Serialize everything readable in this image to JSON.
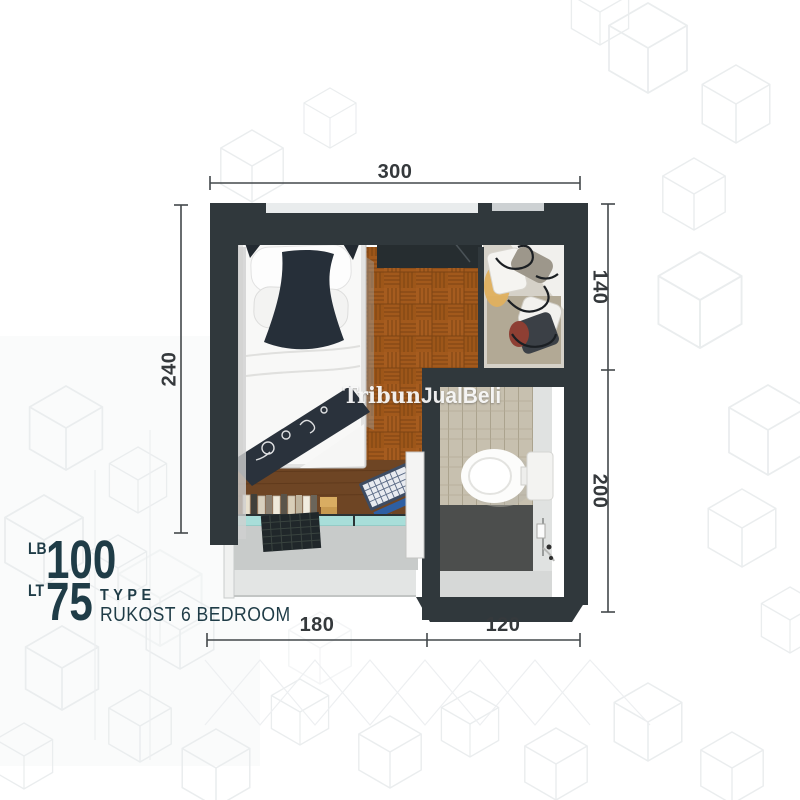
{
  "watermark": {
    "part1": "Tribun",
    "part2": "JualBeli"
  },
  "dims": {
    "top": "300",
    "left": "240",
    "right_upper": "140",
    "right_lower": "200",
    "bottom_left": "180",
    "bottom_right": "120"
  },
  "info": {
    "lb_label": "LB",
    "lb_value": "100",
    "lt_label": "LT",
    "lt_value": "75",
    "type_label": "TYPE",
    "type_name": "RUKOST 6 BEDROOM"
  },
  "palette": {
    "wall_dark": "#30383c",
    "wood_floor": "#a2591c",
    "desk_wood": "#6e4524",
    "glass_teal": "#a8ded9",
    "tile_beige": "#c7c0af",
    "bath_dark_floor": "#4c4e4d",
    "info_text": "#1f3c47",
    "dim_text": "#35393c"
  }
}
